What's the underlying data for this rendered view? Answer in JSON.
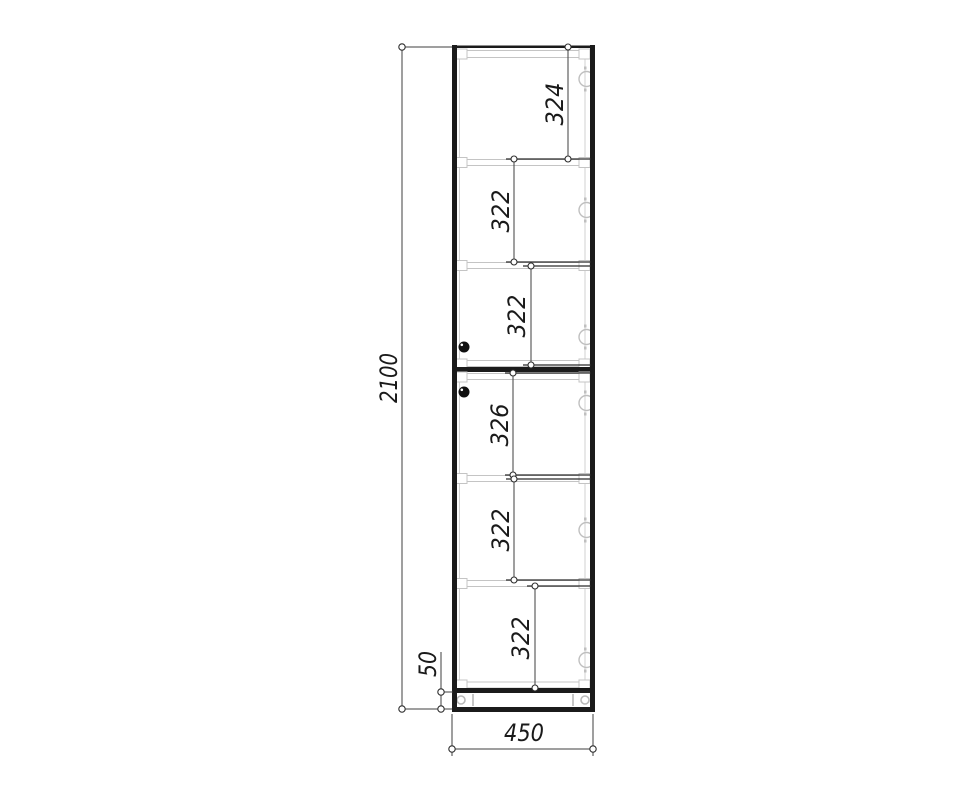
{
  "drawing": {
    "type": "cabinet-front-elevation",
    "dims": {
      "overall_height": "2100",
      "plinth_height": "50",
      "width": "450",
      "sections": [
        "324",
        "322",
        "322",
        "326",
        "322",
        "322"
      ]
    },
    "colors": {
      "outline": "#1b1b1b",
      "panel_gray": "#c4c4c4",
      "dimension_line": "#3f3f3f",
      "text": "#1a1a1a",
      "background": "#ffffff"
    },
    "icons": {
      "hinge": "hinge-cup-circle",
      "handle": "round-knob",
      "dim_terminator": "open-circle"
    }
  }
}
